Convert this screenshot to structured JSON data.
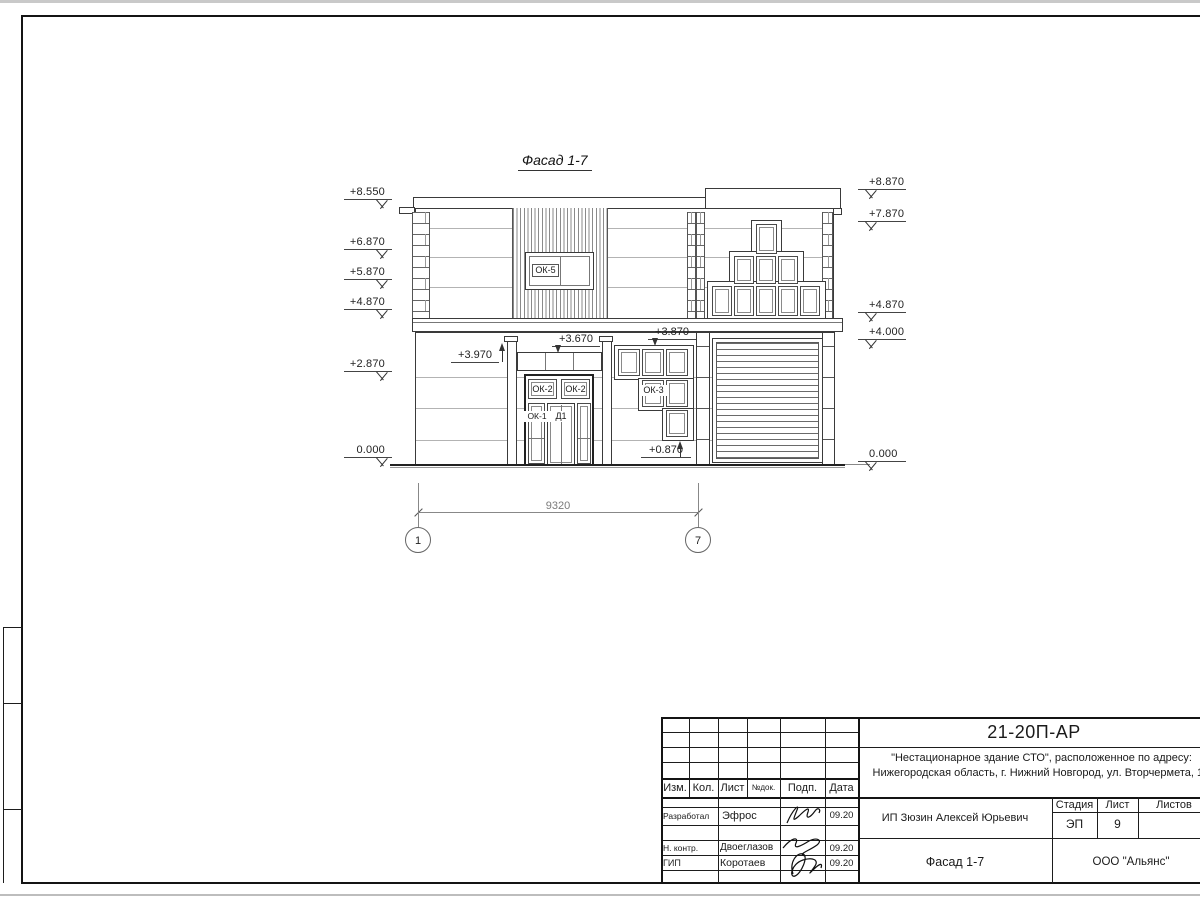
{
  "drawing": {
    "title": "Фасад 1-7",
    "levels_left": [
      {
        "value": "+8.550"
      },
      {
        "value": "+6.870"
      },
      {
        "value": "+5.870"
      },
      {
        "value": "+4.870"
      },
      {
        "value": "+2.870"
      },
      {
        "value": "0.000"
      }
    ],
    "levels_right": [
      {
        "value": "+8.870"
      },
      {
        "value": "+7.870"
      },
      {
        "value": "+4.870"
      },
      {
        "value": "+4.000"
      },
      {
        "value": "0.000"
      }
    ],
    "callouts": {
      "pilaster_top": "+3.970",
      "transom_top": "+3.670",
      "ok3_top": "+3.870",
      "ok3_bottom": "+0.870"
    },
    "labels": {
      "ok5": "ОК-5",
      "ok2_left": "ОК-2",
      "ok2_right": "ОК-2",
      "ok1": "ОК-1",
      "d1": "Д1",
      "ok3": "ОК-3"
    },
    "dimension": {
      "span": "9320",
      "axis_left": "1",
      "axis_right": "7"
    }
  },
  "title_block": {
    "doc_number": "21-20П-АР",
    "project_line1": "\"Нестационарное здание СТО\", расположенное по адресу:",
    "project_line2": "Нижегородская область, г. Нижний Новгород, ул. Вторчермета, 1А",
    "columns": {
      "izm": "Изм.",
      "kol": "Кол.",
      "list": "Лист",
      "ndok": "№док.",
      "podp": "Подп.",
      "data": "Дата"
    },
    "rows": [
      {
        "role": "Разработал",
        "name": "Эфрос",
        "date": "09.20"
      },
      {
        "role": "Н. контр.",
        "name": "Двоеглазов",
        "date": "09.20"
      },
      {
        "role": "ГИП",
        "name": "Коротаев",
        "date": "09.20"
      }
    ],
    "client": "ИП Зюзин Алексей Юрьевич",
    "stage": {
      "label": "Стадия",
      "value": "ЭП"
    },
    "sheet": {
      "label": "Лист",
      "value": "9"
    },
    "sheets_total": {
      "label": "Листов",
      "value": ""
    },
    "view_title": "Фасад 1-7",
    "company": "ООО \"Альянс\""
  }
}
